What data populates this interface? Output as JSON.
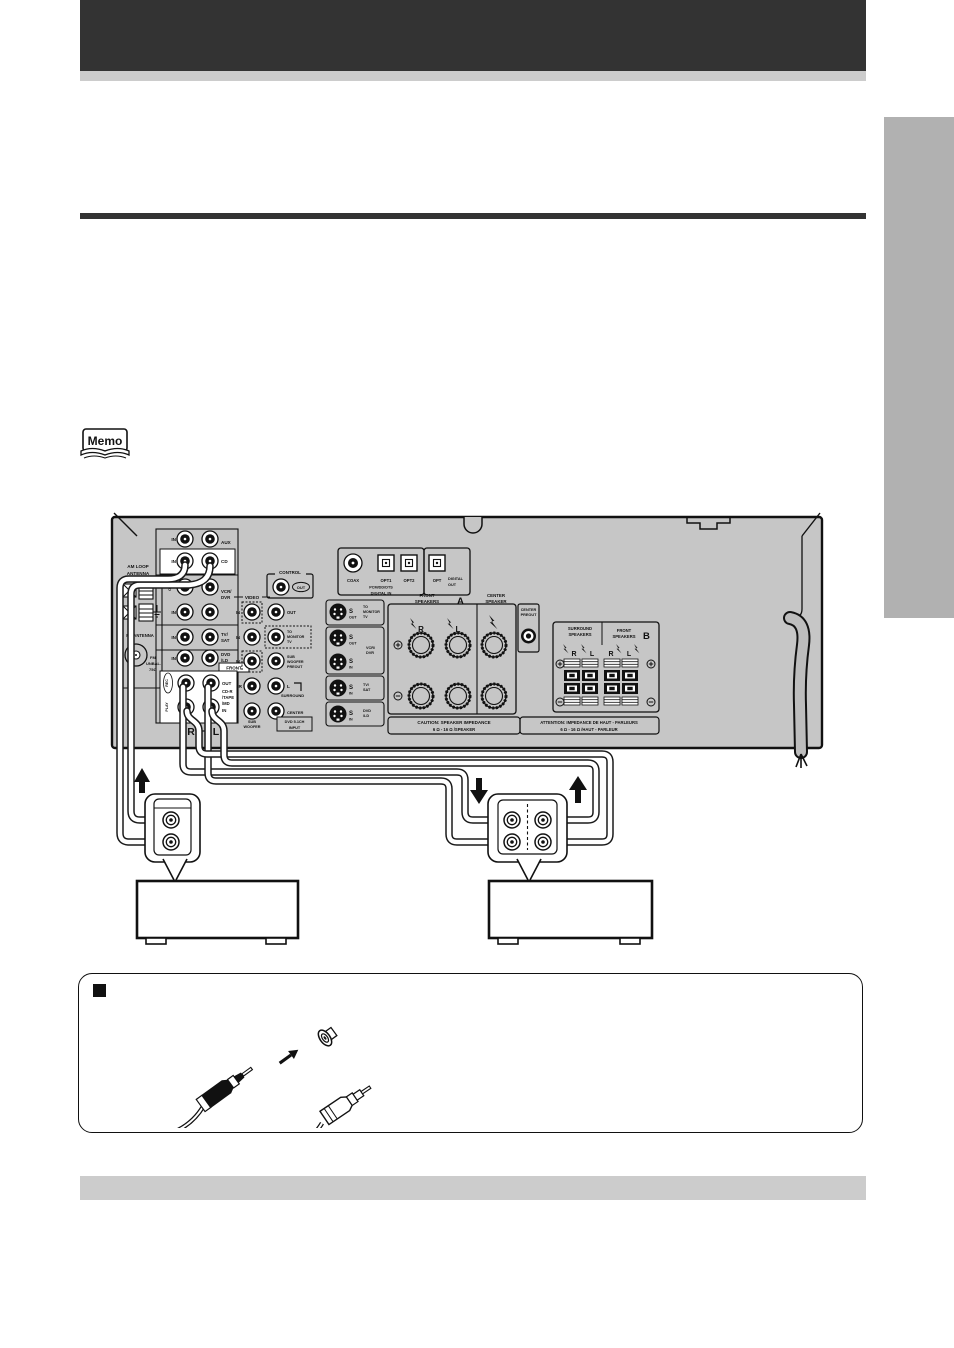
{
  "colors": {
    "header_bar": "#333333",
    "light_bar": "#cccccc",
    "side_tab": "#b1b1b1",
    "panel_gray": "#c6c6c6",
    "ink": "#111111"
  },
  "memo": {
    "label": "Memo"
  },
  "note": {
    "bullet": "■"
  },
  "rx": {
    "amloop1": "AM LOOP",
    "amloop2": "ANTENNA",
    "fmant": "FM ANTENNA",
    "fm": "FM",
    "unbal": "UNBAL.",
    "ohm75": "75Ω",
    "in": "IN",
    "out": "OUT",
    "aux": "AUX",
    "cd": "CD",
    "vcr1": "VCR/",
    "vcr2": "DVR",
    "tv1": "TV/",
    "tv2": "SAT",
    "dvd1": "DVD",
    "dvd2": "/LD",
    "front": "FRONT",
    "rec": "REC",
    "play": "PLAY",
    "cdr1": "CD-R",
    "cdr2": "/TAPE",
    "cdr3": "/MD",
    "r": "R",
    "l": "L",
    "control": "CONTROL",
    "video": "VIDEO",
    "to": "TO",
    "monitor": "MONITOR",
    "tvw": "TV",
    "sub": "SUB",
    "woofer": "WOOFER",
    "preout": "PREOUT",
    "surround": "SURROUND",
    "center": "CENTER",
    "dvd51": "DVD 5.1CH",
    "input": "INPUT",
    "s": "S",
    "coax": "COAX",
    "opt1": "OPT1",
    "opt2": "OPT2",
    "opt": "OPT",
    "pcm": "PCM/DD/DTS",
    "digin": "DIGITAL IN",
    "digital": "DIGITAL",
    "speakers": "SPEAKERS",
    "speaker": "SPEAKER",
    "a": "A",
    "b": "B",
    "caution1": "CAUTION: SPEAKER IMPEDANCE",
    "caution2": "6 Ω - 16 Ω /SPEAKER",
    "attention1": "ATTENTION: IMPEDANCE DE HAUT - PARLEURS",
    "attention2": "6 Ω - 16 Ω /HAUT - PARLEUR"
  }
}
